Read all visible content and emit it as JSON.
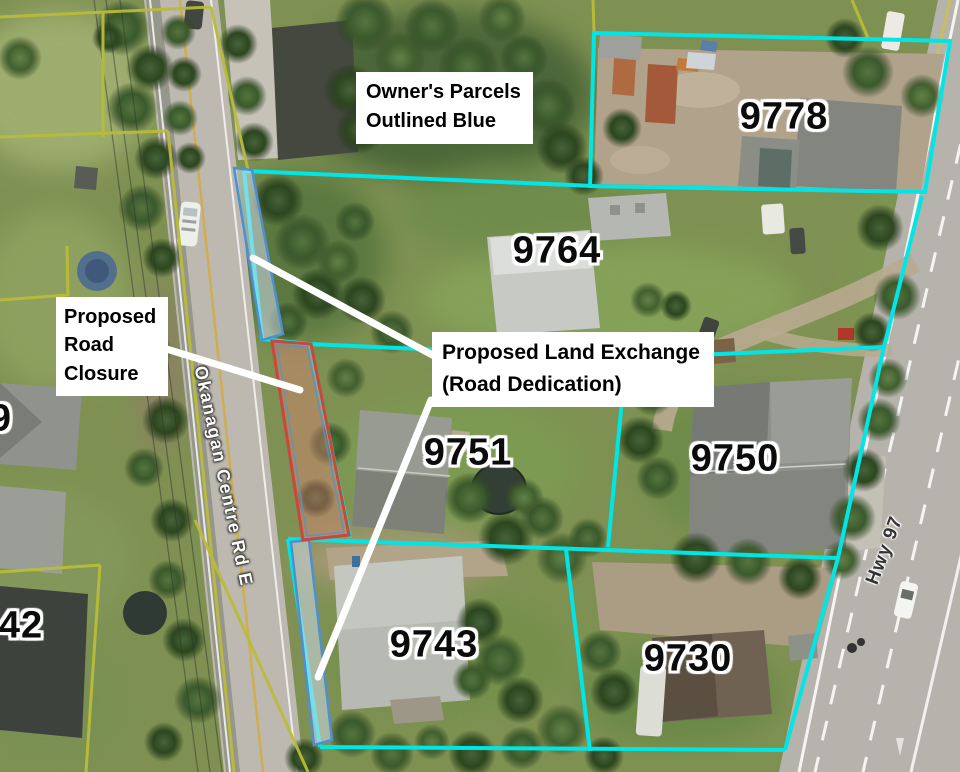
{
  "map_annotations": {
    "owners_note_lines": [
      "Owner's Parcels",
      "Outlined Blue"
    ],
    "road_closure_lines": [
      "Proposed",
      "Road",
      "Closure"
    ],
    "land_exchange_lines": [
      "Proposed Land Exchange",
      "(Road Dedication)"
    ]
  },
  "parcel_numbers": [
    "9778",
    "9764",
    "9751",
    "9750",
    "9743",
    "9730",
    "42",
    "9"
  ],
  "road_names": {
    "okanagan_centre": "Okanagan Centre Rd E",
    "hwy_97": "Hwy 97"
  },
  "colors": {
    "owner_parcel_outline": "#00e6e6",
    "other_parcel_line": "#b9bc38",
    "road_closure_outline": "#c9473c",
    "road_closure_fill": "rgba(222,130,118,0.42)",
    "land_exchange_outline": "#4e8fd0",
    "land_exchange_fill": "rgba(205,218,235,0.55)",
    "annotation_line": "#ffffff",
    "annotation_box_bg": "#ffffff",
    "annotation_text": "#000000"
  }
}
